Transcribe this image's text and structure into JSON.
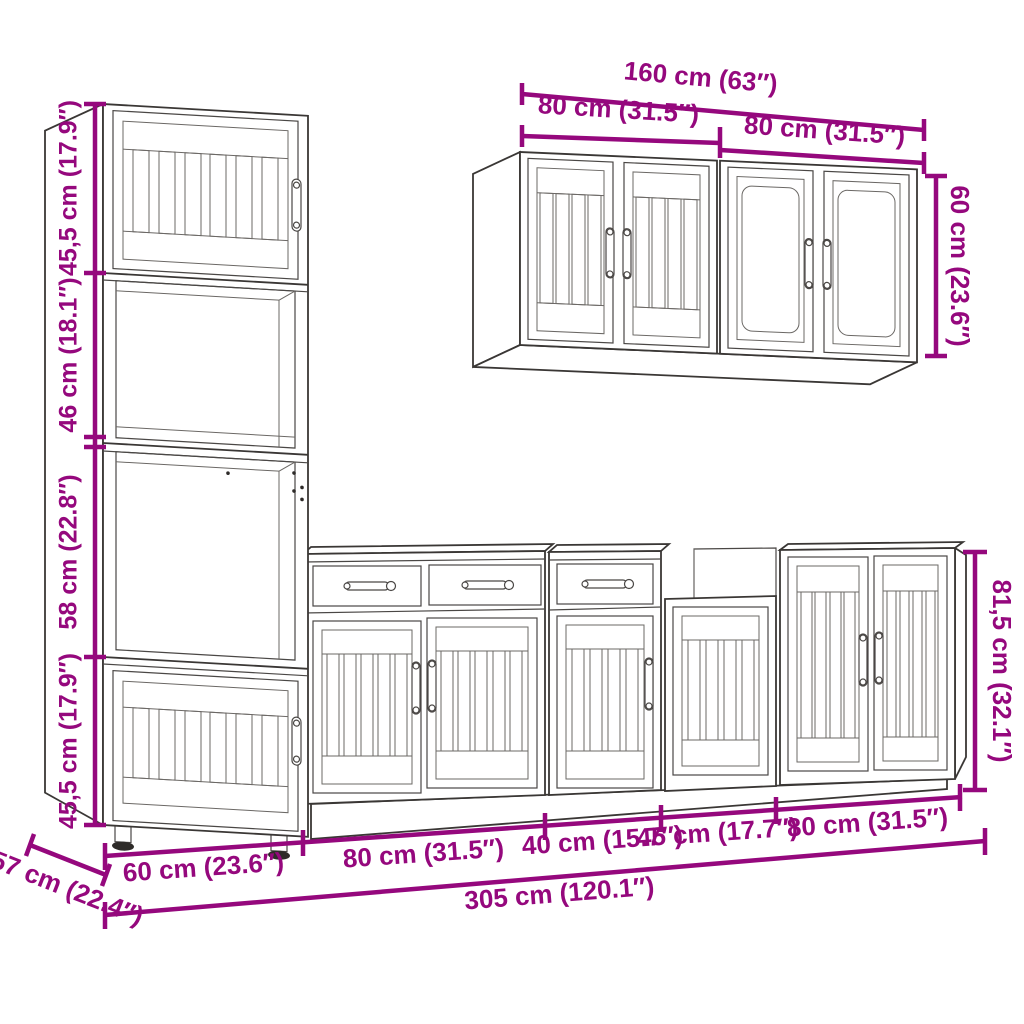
{
  "dims": {
    "tall_s1": "45,5 cm (17.9″)",
    "tall_s2": "46 cm (18.1″)",
    "tall_s3": "58 cm (22.8″)",
    "tall_s4": "45,5 cm (17.9″)",
    "tall_width": "60 cm (23.6″)",
    "tall_depth": "57 cm (22.4″)",
    "wall_total": "160 cm (63″)",
    "wall_left": "80 cm (31.5″)",
    "wall_right": "80 cm (31.5″)",
    "wall_height": "60 cm (23.6″)",
    "base_80a": "80 cm (31.5″)",
    "base_40": "40 cm (15.7″)",
    "base_45": "45 cm (17.7″)",
    "base_80b": "80 cm (31.5″)",
    "base_total": "305 cm (120.1″)",
    "base_height": "81,5 cm (32.1″)"
  },
  "colors": {
    "dimension": "#95087D",
    "line_art": "#3a3735",
    "background": "#ffffff"
  }
}
